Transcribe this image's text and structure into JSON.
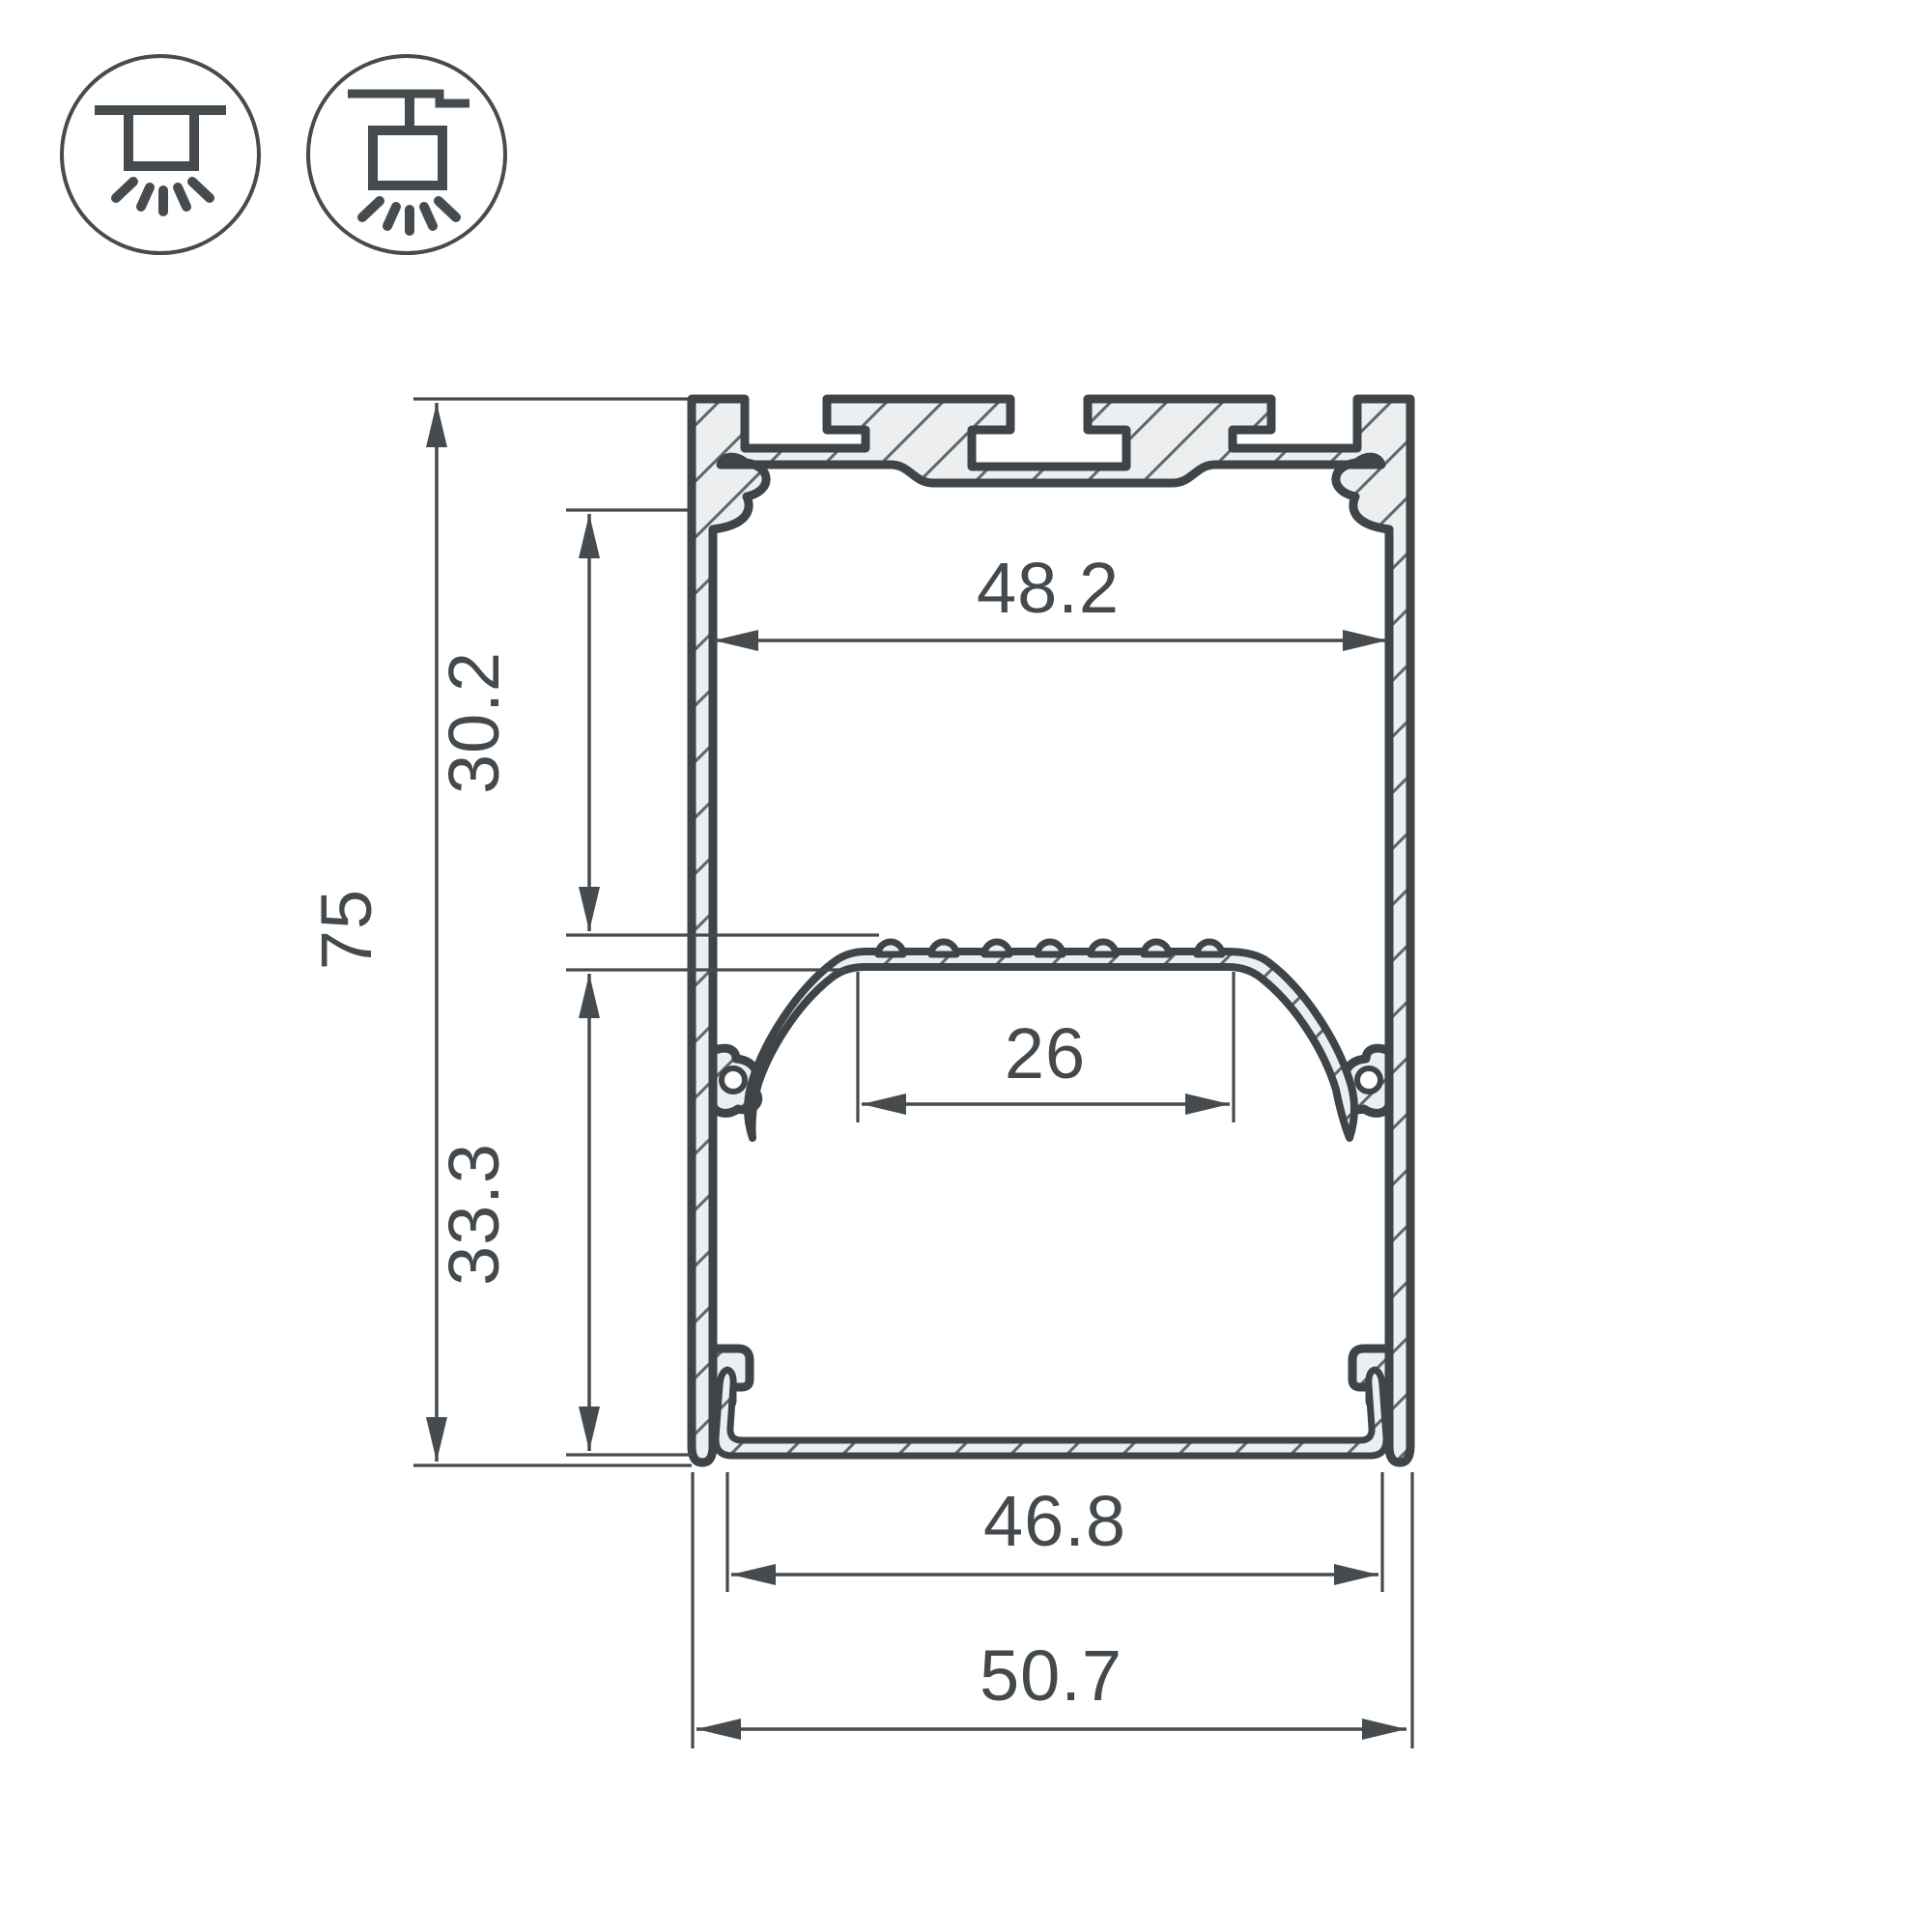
{
  "drawing": {
    "title": "led-profile-cross-section",
    "type": "technical dimension drawing",
    "mount_icons": {
      "surface": "surface-ceiling-mount",
      "pendant": "suspended-pendant-mount"
    },
    "dimensions": {
      "overall_height": "75",
      "upper_inner_height": "30.2",
      "lower_inner_height": "33.3",
      "inner_top_width": "48.2",
      "led_shelf_width": "26",
      "bottom_opening_width": "46.8",
      "overall_width": "50.7"
    },
    "colors": {
      "line": "#3e4448",
      "dimension_line": "#454b4f",
      "metal_fill": "#eceeef",
      "background": "#ffffff"
    }
  }
}
